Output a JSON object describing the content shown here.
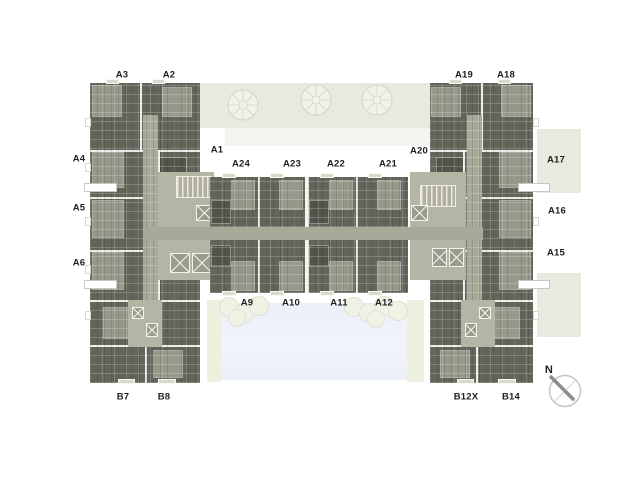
{
  "labels": {
    "top_left": {
      "a3": "A3",
      "a2": "A2"
    },
    "top_right": {
      "a19": "A19",
      "a18": "A18"
    },
    "left_column": {
      "a4": "A4",
      "a5": "A5",
      "a6": "A6"
    },
    "right_column": {
      "a17": "A17",
      "a16": "A16",
      "a15": "A15"
    },
    "center_upper": {
      "a1": "A1",
      "a24": "A24",
      "a23": "A23",
      "a22": "A22",
      "a21": "A21",
      "a20": "A20"
    },
    "center_lower": {
      "a9": "A9",
      "a10": "A10",
      "a11": "A11",
      "a12": "A12"
    },
    "bottom_left": {
      "b7": "B7",
      "b8": "B8"
    },
    "bottom_right": {
      "b12x": "B12X",
      "b14": "B14"
    }
  },
  "compass": {
    "north_label": "N"
  },
  "colors": {
    "unit_dark": "#64645a",
    "unit_darker": "#54544b",
    "room_light": "#97978a",
    "corridor": "#a9a999",
    "core_light": "#b5b5a6",
    "beige_band": "#e9e9df",
    "beige_light": "#f4f4ee",
    "deck": "#edefdf",
    "pool": "#ebeff8",
    "bush_fill": "#f0f2e6",
    "bush_edge": "#dfe2d0",
    "tree_fill": "#f2f2e9",
    "tree_edge": "#d9dac9",
    "label_color": "#1f1f1f",
    "compass_needle": "#8c8c8c",
    "compass_ring": "#c6c6c6"
  }
}
